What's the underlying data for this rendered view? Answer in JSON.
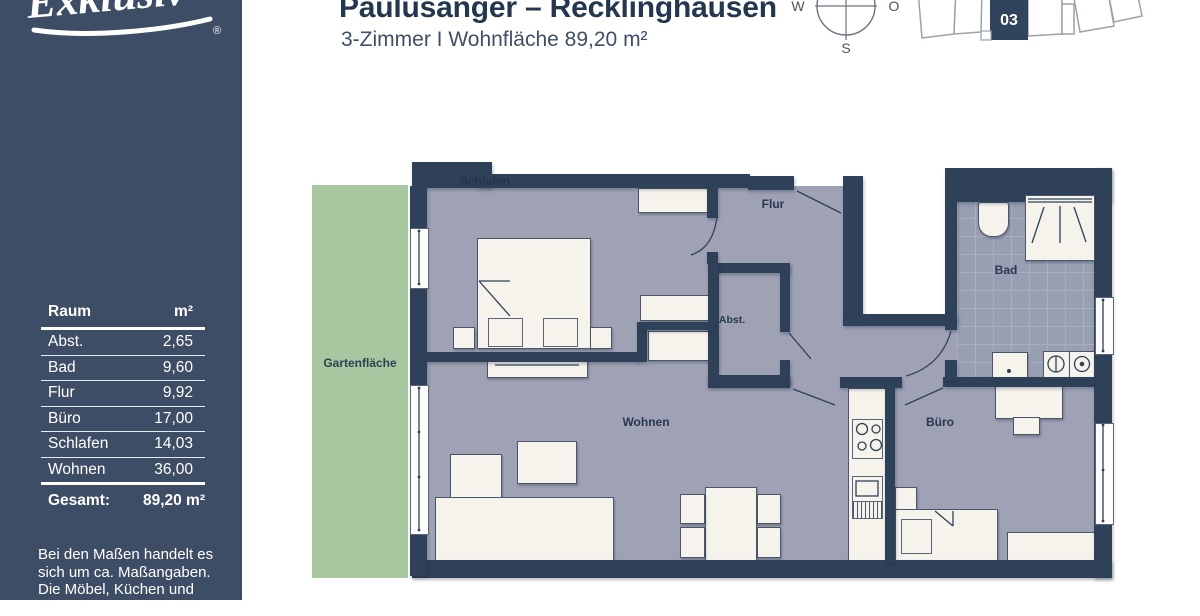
{
  "header": {
    "title": "Paulusanger – Recklinghausen",
    "subtitle": "3-Zimmer I Wohnfläche 89,20 m²"
  },
  "sidebar": {
    "logo": {
      "text": "Exklusiv",
      "registered": "®"
    },
    "table": {
      "header": {
        "room": "Raum",
        "area": "m²"
      },
      "rows": [
        {
          "name": "Abst.",
          "value": "2,65"
        },
        {
          "name": "Bad",
          "value": "9,60"
        },
        {
          "name": "Flur",
          "value": "9,92"
        },
        {
          "name": "Büro",
          "value": "17,00"
        },
        {
          "name": "Schlafen",
          "value": "14,03"
        },
        {
          "name": "Wohnen",
          "value": "36,00"
        }
      ],
      "total": {
        "name": "Gesamt:",
        "value": "89,20 m²"
      }
    },
    "disclaimer": {
      "line1": "Bei den Maßen handelt es",
      "line2": "sich um ca. Maßangaben.",
      "line3": "Die Möbel, Küchen und",
      "line4": "Sanitärobjekte sind"
    }
  },
  "compass": {
    "west": "W",
    "east": "O",
    "south": "S"
  },
  "siteplan": {
    "unit": "03"
  },
  "floorplan": {
    "labels": {
      "schlafen": "Schlafen",
      "flur": "Flur",
      "abst": "Abst.",
      "bad": "Bad",
      "wohnen": "Wohnen",
      "buero": "Büro",
      "garten": "Gartenfläche"
    }
  },
  "colors": {
    "sidebar": "#3e4d66",
    "wall": "#2e4158",
    "room": "#9ea2b4",
    "tiles": "#999fb2",
    "garden": "#a7c7a0",
    "furniture": "#f6f3ec",
    "title": "#233750"
  }
}
